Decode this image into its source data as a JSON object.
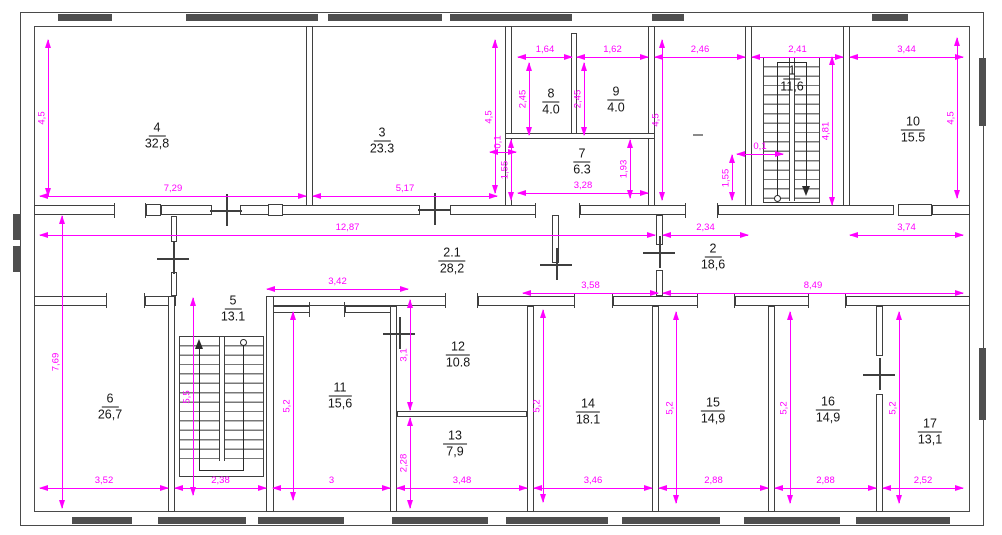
{
  "drawing": {
    "type": "floor-plan",
    "colors": {
      "dimension": "#ff00ff",
      "wall": "#3f3f3f",
      "wall_fill": "#4f4f4f",
      "text": "#161616"
    },
    "rooms": {
      "r1": {
        "number": "1",
        "area": "11,6"
      },
      "r2": {
        "number": "2",
        "area": "18,6"
      },
      "r21": {
        "number": "2.1",
        "area": "28,2"
      },
      "r3": {
        "number": "3",
        "area": "23.3"
      },
      "r4": {
        "number": "4",
        "area": "32,8"
      },
      "r5": {
        "number": "5",
        "area": "13.1"
      },
      "r6": {
        "number": "6",
        "area": "26,7"
      },
      "r7": {
        "number": "7",
        "area": "6.3"
      },
      "r8": {
        "number": "8",
        "area": "4.0"
      },
      "r9": {
        "number": "9",
        "area": "4.0"
      },
      "r10": {
        "number": "10",
        "area": "15.5"
      },
      "r11": {
        "number": "11",
        "area": "15,6"
      },
      "r12": {
        "number": "12",
        "area": "10.8"
      },
      "r13": {
        "number": "13",
        "area": "7,9"
      },
      "r14": {
        "number": "14",
        "area": "18.1"
      },
      "r15": {
        "number": "15",
        "area": "14,9"
      },
      "r16": {
        "number": "16",
        "area": "14,9"
      },
      "r17": {
        "number": "17",
        "area": "13,1"
      }
    },
    "dims": {
      "d_w4": "7,29",
      "d_w3": "5,17",
      "d_w7": "3,28",
      "d_w8": "1,64",
      "d_w9": "1,62",
      "d_w18": "2,46",
      "d_w1": "2,41",
      "d_w10": "3,44",
      "d_corr": "12,87",
      "d_234": "2,34",
      "d_w11t": "3,42",
      "d_358": "3,58",
      "d_849": "8,49",
      "d_374": "3,74",
      "d_01a": "0,1",
      "d_01b": "0,1",
      "d_b6": "3,52",
      "d_b5": "2,38",
      "d_b11": "3",
      "d_b13": "3,48",
      "d_b14": "3,46",
      "d_b15": "2,88",
      "d_b16": "2,88",
      "d_b17": "2,52",
      "v_h4": "4,5",
      "v_h3": "4,5",
      "v_r8": "2,45",
      "v_r9": "2,45",
      "v_r18": "4,5",
      "v_r1": "4,81",
      "v_r10": "4,5",
      "v_155a": "1,55",
      "v_193": "1,93",
      "v_155b": "1,55",
      "v_h6": "7,69",
      "v_h5": "5,5",
      "v_h11": "5,2",
      "v_h12": "3,1",
      "v_h13": "2,28",
      "v_h14": "5,2",
      "v_h15": "5,2",
      "v_h16": "5,2",
      "v_h17": "5,2"
    }
  }
}
